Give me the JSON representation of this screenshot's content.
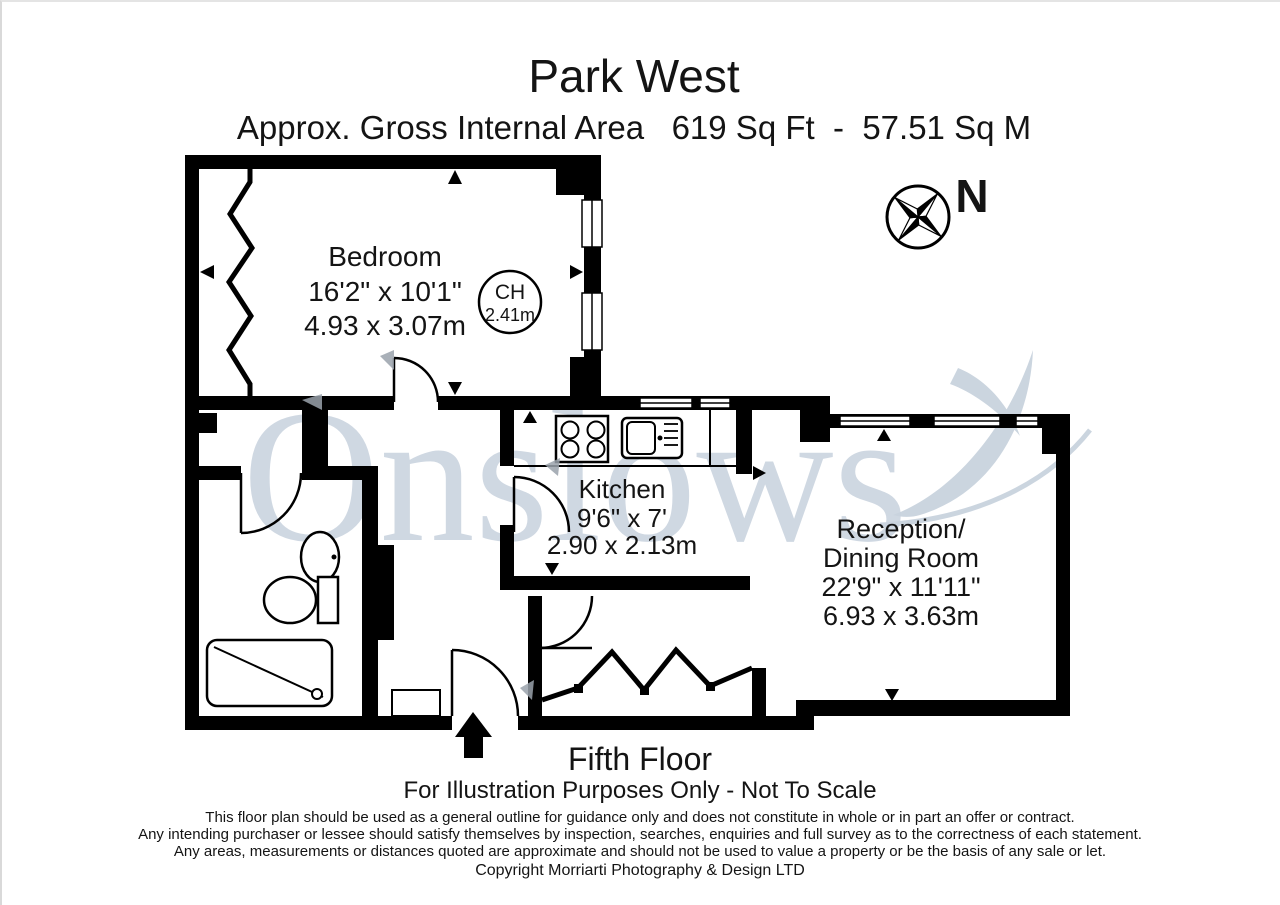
{
  "header": {
    "title": "Park West",
    "subtitle": "Approx. Gross Internal Area   619 Sq Ft  -  57.51 Sq M"
  },
  "watermark": {
    "text": "Onslows"
  },
  "compass": {
    "label": "N"
  },
  "rooms": {
    "bedroom": {
      "name": "Bedroom",
      "imperial": "16'2\" x 10'1\"",
      "metric": "4.93 x 3.07m"
    },
    "kitchen": {
      "name": "Kitchen",
      "imperial": "9'6\" x 7'",
      "metric": "2.90 x 2.13m"
    },
    "reception": {
      "name_line1": "Reception/",
      "name_line2": "Dining Room",
      "imperial": "22'9\" x 11'11\"",
      "metric": "6.93 x 3.63m"
    },
    "ceiling_height": {
      "label": "CH",
      "value": "2.41m"
    }
  },
  "footer": {
    "floor": "Fifth Floor",
    "scale_note": "For Illustration Purposes Only - Not To Scale",
    "disclaimer": [
      "This floor plan should be used as a general outline for guidance only and does not constitute in whole or in part an offer or contract.",
      "Any intending purchaser or lessee should satisfy themselves by inspection, searches, enquiries and full survey as to the correctness of each statement.",
      "Any areas, measurements or distances quoted are approximate and should not be used to value a property or be the basis of any sale or let."
    ],
    "copyright": "Copyright Morriarti Photography & Design LTD"
  },
  "colors": {
    "wall": "#000000",
    "watermark": "#ccd5e0"
  }
}
